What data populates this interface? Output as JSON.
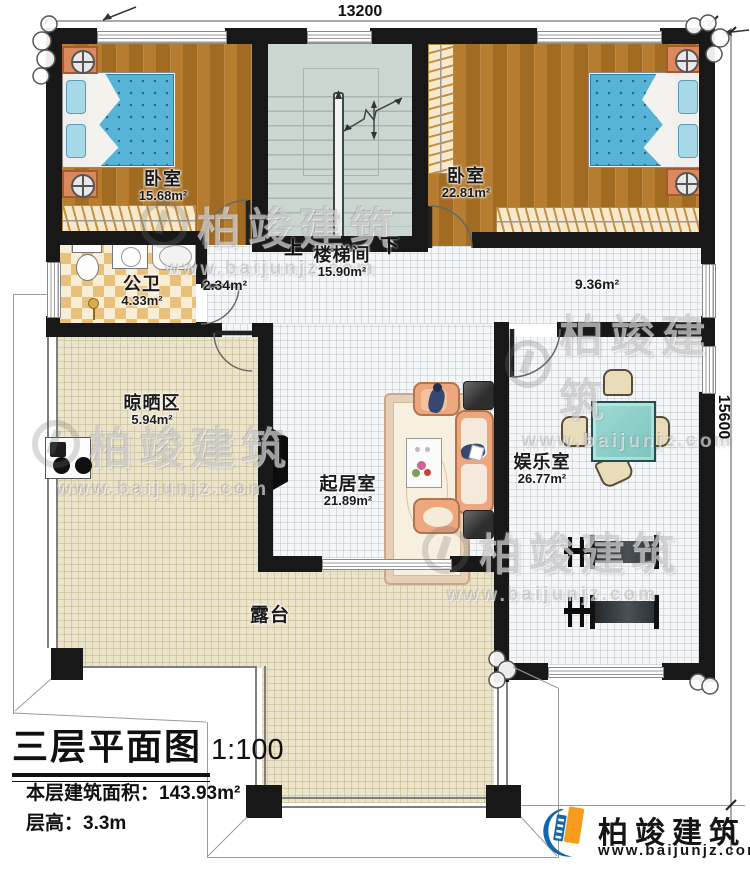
{
  "dimensions": {
    "top": "13200",
    "right": "15600"
  },
  "rooms": {
    "bedroom1": {
      "name": "卧室",
      "area": "15.68m²"
    },
    "bedroom2": {
      "name": "卧室",
      "area": "22.81m²"
    },
    "stairwell": {
      "name": "楼梯间",
      "area": "15.90m²",
      "up": "上",
      "down": "下"
    },
    "bathroom": {
      "name": "公卫",
      "area": "4.33m²"
    },
    "corridor": {
      "area": "2.34m²"
    },
    "hall": {
      "area": "9.36m²"
    },
    "drying": {
      "name": "晾晒区",
      "area": "5.94m²"
    },
    "living": {
      "name": "起居室",
      "area": "21.89m²"
    },
    "entertainment": {
      "name": "娱乐室",
      "area": "26.77m²"
    },
    "terrace": {
      "name": "露台"
    }
  },
  "title_block": {
    "title": "三层平面图",
    "scale": "1:100",
    "area_line": "本层建筑面积：143.93m²",
    "floor_height_line": "层高：3.3m"
  },
  "brand": {
    "name": "柏竣建筑",
    "url": "www.baijunjz.com"
  },
  "watermark": {
    "text": "柏竣建筑",
    "url": "www.baijunjz.com"
  },
  "colors": {
    "wall": "#181818",
    "wood_floor": "#ab742b",
    "bed_blue": "#58b4d7",
    "terrace_beige": "#ece4ca",
    "bath_tile": "#e9c07a",
    "stair_gray": "#ccd6d0",
    "table_teal": "#8fd2cb",
    "sofa_peach": "#eda77f",
    "logo_blue": "#1166b0",
    "logo_orange": "#f59c1c"
  }
}
